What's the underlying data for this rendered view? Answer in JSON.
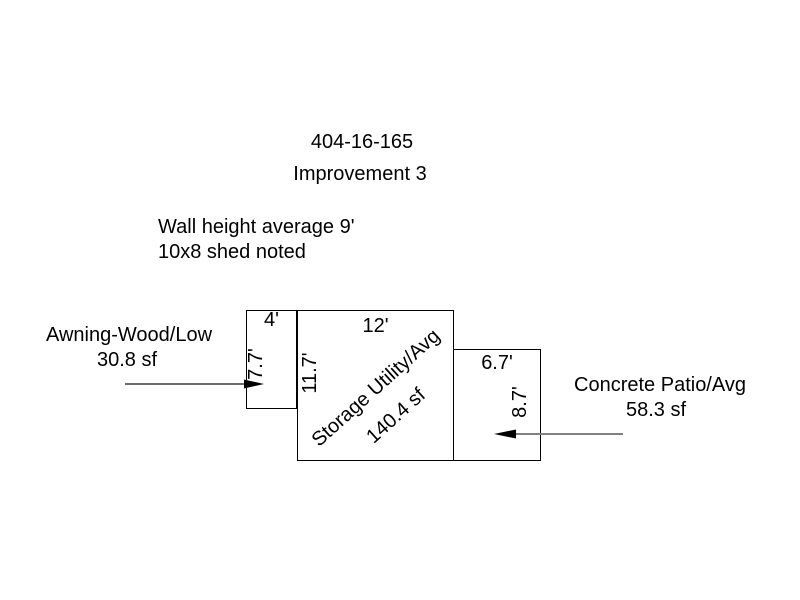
{
  "header": {
    "parcel_id": "404-16-165",
    "improvement": "Improvement 3"
  },
  "notes": {
    "wall_height": "Wall height average 9'",
    "shed": "10x8 shed noted"
  },
  "sketch": {
    "awning": {
      "name": "Awning-Wood/Low",
      "area": "30.8 sf",
      "width_dim": "4'",
      "height_dim": "7.7'"
    },
    "storage": {
      "name": "Storage Utility/Avg",
      "area": "140.4 sf",
      "width_dim": "12'",
      "height_dim": "11.7'"
    },
    "patio": {
      "name": "Concrete Patio/Avg",
      "area": "58.3 sf",
      "width_dim": "6.7'",
      "height_dim": "8.7'"
    }
  },
  "colors": {
    "background": "#ffffff",
    "outline": "#000000",
    "text": "#000000",
    "awning_arrow_line": "#3c3c3c",
    "patio_arrow_line": "#808080",
    "arrowhead": "#000000"
  }
}
